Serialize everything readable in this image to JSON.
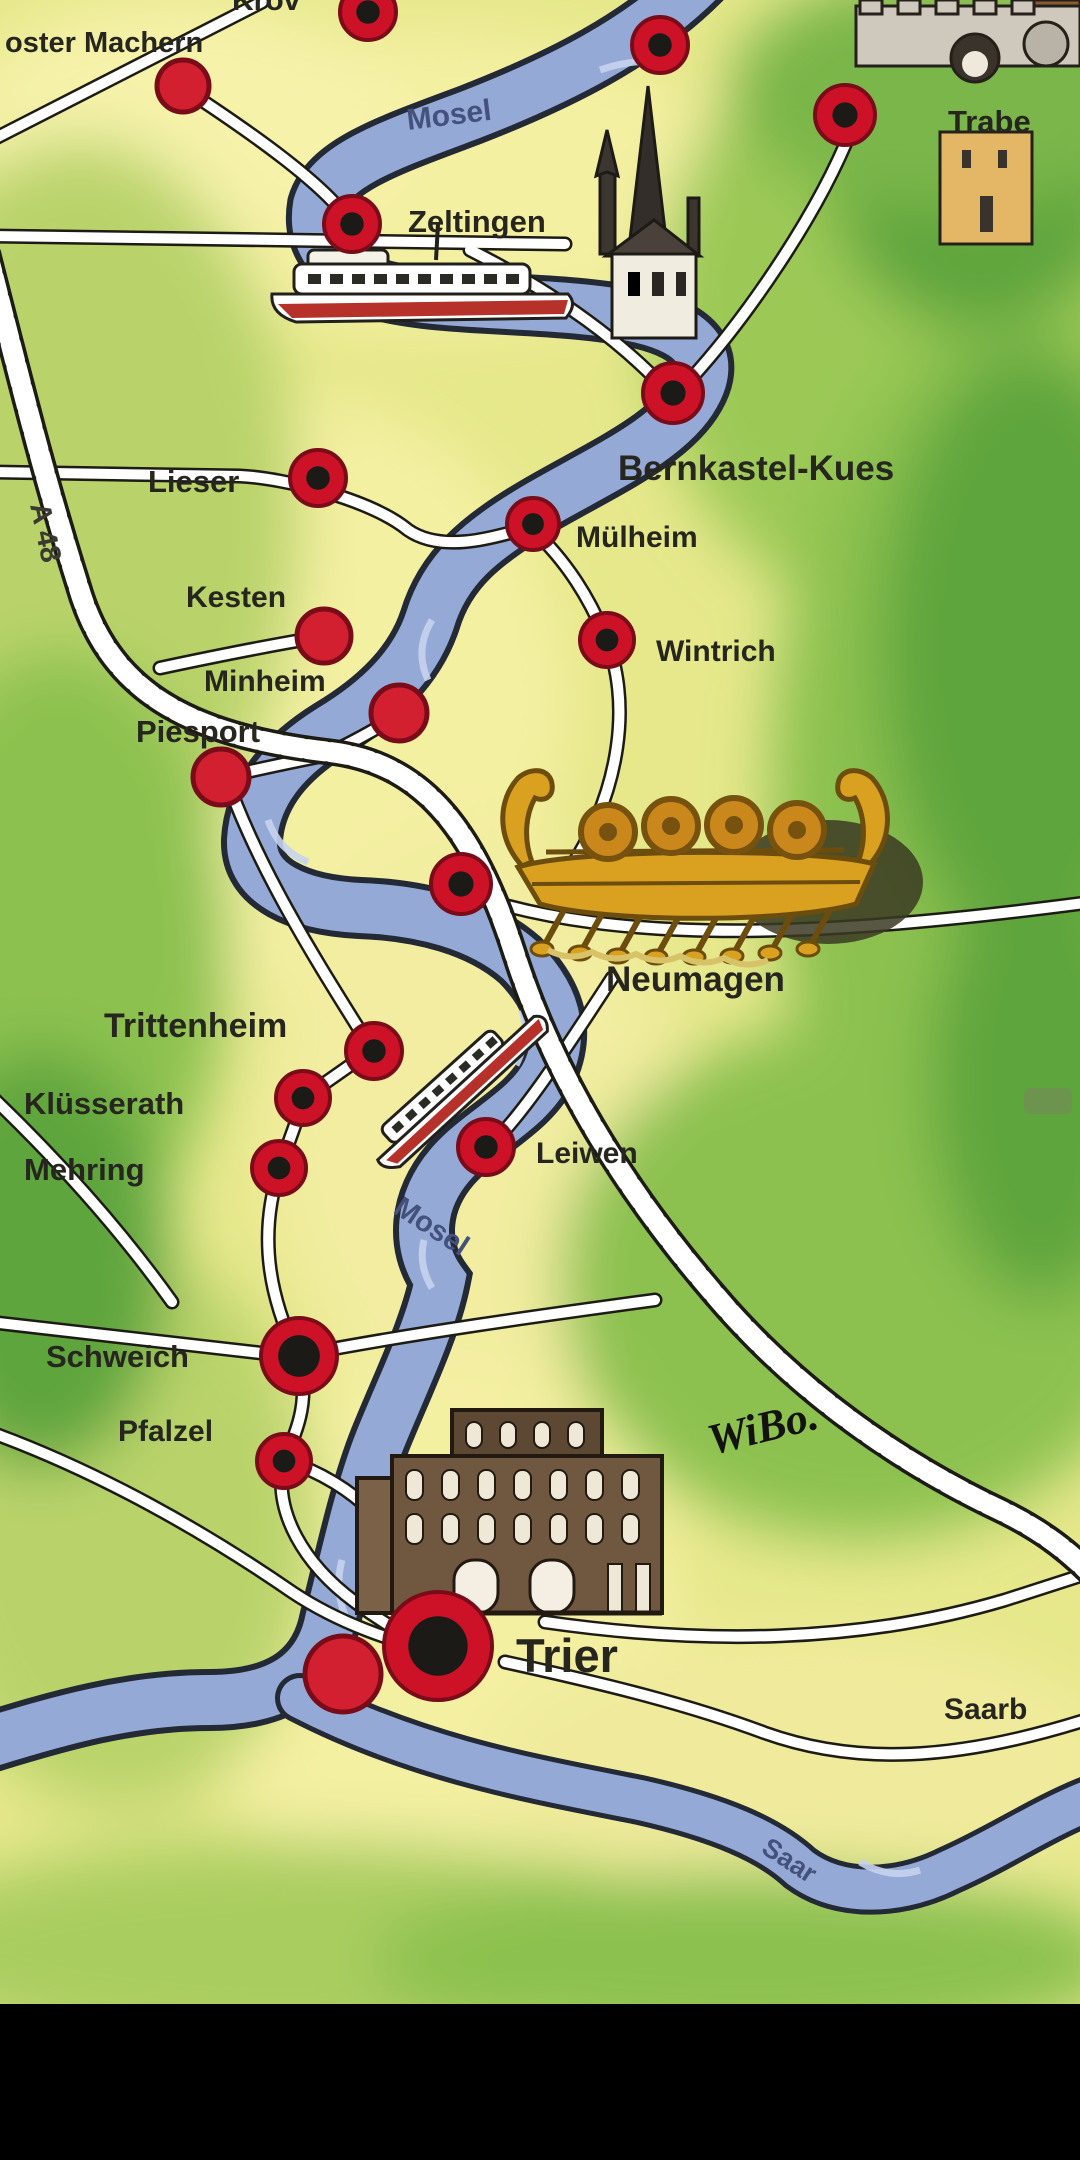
{
  "map": {
    "type": "illustrated-tourist-map",
    "colors": {
      "paper_yellow": "#e9ea8c",
      "valley_yellow": "#f4f0a2",
      "green_light": "#b9d36a",
      "green_mid": "#8cc14f",
      "green_dark": "#5fa53c",
      "river_blue": "#94a9d6",
      "river_outline": "#232a36",
      "road_white": "#ffffff",
      "road_outline": "#1c1b14",
      "dot_red": "#cd1228",
      "dot_red_solid": "#d32030",
      "dot_core": "#1c1a16",
      "label_ink": "#26251e",
      "river_label_ink": "#44517c",
      "ship_gold": "#d9a11f",
      "porta_brown": "#6e573f",
      "black_bar": "#000000"
    },
    "town_labels": [
      {
        "id": "kroev",
        "text": "Kröv",
        "x": 232,
        "y": 10,
        "size": 30,
        "rot": 0,
        "weight": 700,
        "note": "clipped-at-top-edge"
      },
      {
        "id": "kloster-machern",
        "text": "oster Machern",
        "x": 5,
        "y": 52,
        "size": 29,
        "rot": 0,
        "weight": 600,
        "note": "clipped-at-left-edge"
      },
      {
        "id": "zeltingen",
        "text": "Zeltingen",
        "x": 408,
        "y": 232,
        "size": 31,
        "rot": 0,
        "weight": 600
      },
      {
        "id": "traben",
        "text": "Trabe",
        "x": 948,
        "y": 132,
        "size": 31,
        "rot": 0,
        "weight": 600,
        "note": "clipped-at-right-edge"
      },
      {
        "id": "bernkastel-kues",
        "text": "Bernkastel-Kues",
        "x": 618,
        "y": 480,
        "size": 35,
        "rot": 0,
        "weight": 700
      },
      {
        "id": "lieser",
        "text": "Lieser",
        "x": 148,
        "y": 492,
        "size": 31,
        "rot": 0,
        "weight": 600
      },
      {
        "id": "muelheim",
        "text": "Mülheim",
        "x": 576,
        "y": 547,
        "size": 30,
        "rot": 0,
        "weight": 600
      },
      {
        "id": "kesten",
        "text": "Kesten",
        "x": 186,
        "y": 607,
        "size": 30,
        "rot": 0,
        "weight": 600
      },
      {
        "id": "wintrich",
        "text": "Wintrich",
        "x": 656,
        "y": 661,
        "size": 30,
        "rot": 0,
        "weight": 600
      },
      {
        "id": "minheim",
        "text": "Minheim",
        "x": 204,
        "y": 691,
        "size": 30,
        "rot": 0,
        "weight": 700
      },
      {
        "id": "piesport",
        "text": "Piesport",
        "x": 136,
        "y": 742,
        "size": 31,
        "rot": 0,
        "weight": 600
      },
      {
        "id": "neumagen",
        "text": "Neumagen",
        "x": 606,
        "y": 991,
        "size": 35,
        "rot": 0,
        "weight": 700
      },
      {
        "id": "trittenheim",
        "text": "Trittenheim",
        "x": 104,
        "y": 1037,
        "size": 34,
        "rot": 0,
        "weight": 700
      },
      {
        "id": "kluesserath",
        "text": "Klüsserath",
        "x": 24,
        "y": 1114,
        "size": 31,
        "rot": 0,
        "weight": 600
      },
      {
        "id": "mehring",
        "text": "Mehring",
        "x": 24,
        "y": 1180,
        "size": 31,
        "rot": 0,
        "weight": 600
      },
      {
        "id": "leiwen",
        "text": "Leiwen",
        "x": 536,
        "y": 1163,
        "size": 30,
        "rot": 0,
        "weight": 600
      },
      {
        "id": "schweich",
        "text": "Schweich",
        "x": 46,
        "y": 1367,
        "size": 31,
        "rot": 0,
        "weight": 600
      },
      {
        "id": "pfalzel",
        "text": "Pfalzel",
        "x": 118,
        "y": 1441,
        "size": 30,
        "rot": 0,
        "weight": 600
      },
      {
        "id": "trier",
        "text": "Trier",
        "x": 516,
        "y": 1672,
        "size": 47,
        "rot": 0,
        "weight": 700
      },
      {
        "id": "saarburg",
        "text": "Saarb",
        "x": 944,
        "y": 1719,
        "size": 30,
        "rot": 0,
        "weight": 600,
        "note": "clipped-at-right-edge"
      }
    ],
    "river_labels": [
      {
        "id": "mosel-upper",
        "text": "Mosel",
        "x": 408,
        "y": 130,
        "size": 30,
        "rot": -7
      },
      {
        "id": "mosel-lower",
        "text": "Mosel",
        "x": 392,
        "y": 1212,
        "size": 29,
        "rot": 33
      },
      {
        "id": "saar",
        "text": "Saar",
        "x": 760,
        "y": 1852,
        "size": 27,
        "rot": 33
      }
    ],
    "road_label": {
      "id": "a48",
      "text": "A 48",
      "x": 30,
      "y": 505,
      "size": 29,
      "rot": 78
    },
    "signature": {
      "id": "wibo",
      "text": "WiBo.",
      "x": 712,
      "y": 1455,
      "size": 44,
      "rot": -14
    },
    "dots": [
      {
        "id": "dot-kroev",
        "x": 368,
        "y": 12,
        "r": 28,
        "style": "ring"
      },
      {
        "id": "dot-machern",
        "x": 183,
        "y": 86,
        "r": 26,
        "style": "solid"
      },
      {
        "id": "dot-uerzig",
        "x": 660,
        "y": 45,
        "r": 28,
        "style": "ring"
      },
      {
        "id": "dot-traben",
        "x": 845,
        "y": 115,
        "r": 30,
        "style": "ring"
      },
      {
        "id": "dot-zeltingen",
        "x": 352,
        "y": 224,
        "r": 28,
        "style": "ring"
      },
      {
        "id": "dot-bernkastel",
        "x": 673,
        "y": 393,
        "r": 30,
        "style": "ring"
      },
      {
        "id": "dot-lieser",
        "x": 318,
        "y": 478,
        "r": 28,
        "style": "ring"
      },
      {
        "id": "dot-muelheim",
        "x": 533,
        "y": 524,
        "r": 26,
        "style": "ring"
      },
      {
        "id": "dot-kesten",
        "x": 324,
        "y": 636,
        "r": 27,
        "style": "solid"
      },
      {
        "id": "dot-wintrich",
        "x": 607,
        "y": 640,
        "r": 27,
        "style": "ring"
      },
      {
        "id": "dot-minheim",
        "x": 399,
        "y": 713,
        "r": 28,
        "style": "solid"
      },
      {
        "id": "dot-piesport",
        "x": 221,
        "y": 777,
        "r": 28,
        "style": "solid"
      },
      {
        "id": "dot-neumagen",
        "x": 461,
        "y": 884,
        "r": 30,
        "style": "ring"
      },
      {
        "id": "dot-trittenheim",
        "x": 374,
        "y": 1051,
        "r": 28,
        "style": "ring"
      },
      {
        "id": "dot-kluesserath",
        "x": 303,
        "y": 1098,
        "r": 27,
        "style": "ring"
      },
      {
        "id": "dot-mehring",
        "x": 279,
        "y": 1168,
        "r": 27,
        "style": "ring"
      },
      {
        "id": "dot-leiwen",
        "x": 486,
        "y": 1147,
        "r": 28,
        "style": "ring"
      },
      {
        "id": "dot-schweich",
        "x": 299,
        "y": 1356,
        "r": 38,
        "style": "ring-large"
      },
      {
        "id": "dot-pfalzel",
        "x": 284,
        "y": 1461,
        "r": 27,
        "style": "ring"
      },
      {
        "id": "dot-trier-main",
        "x": 438,
        "y": 1646,
        "r": 54,
        "style": "ring-large"
      },
      {
        "id": "dot-trier-small",
        "x": 343,
        "y": 1674,
        "r": 38,
        "style": "solid"
      }
    ],
    "illustrations": [
      {
        "id": "traben-castle"
      },
      {
        "id": "bernkastel-church"
      },
      {
        "id": "excursion-ship-zeltingen"
      },
      {
        "id": "roman-wine-ship-neumagen"
      },
      {
        "id": "excursion-ship-trittenheim"
      },
      {
        "id": "porta-nigra-trier"
      }
    ]
  }
}
